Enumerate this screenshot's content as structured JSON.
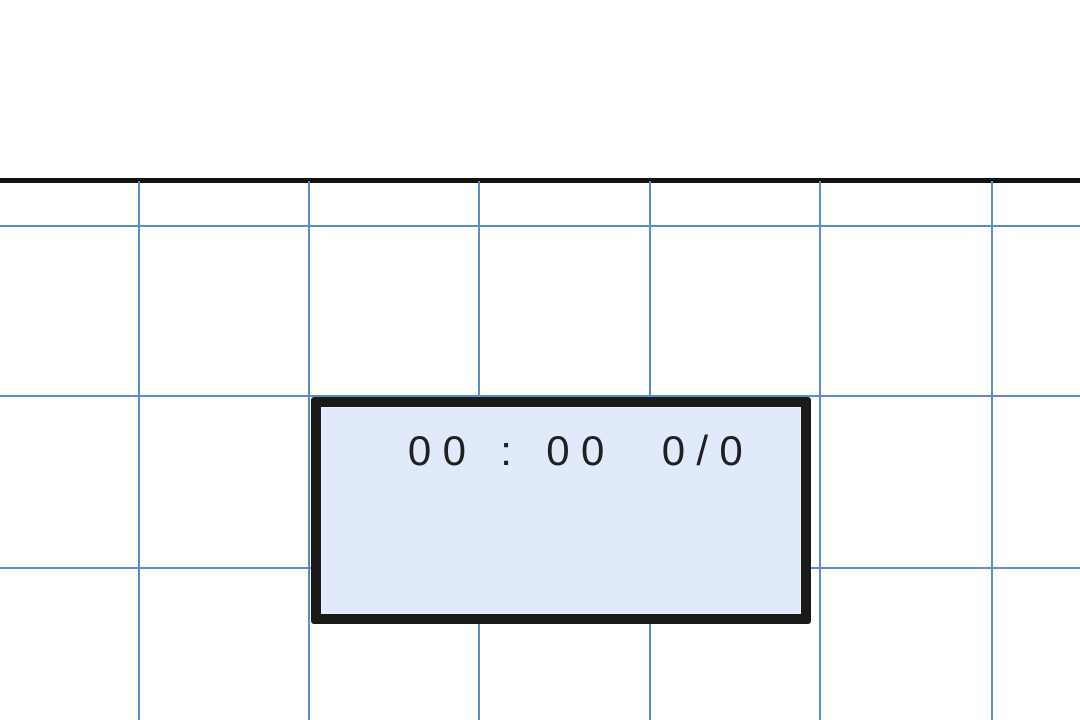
{
  "scene": {
    "background_color": "#ffffff",
    "top_line_color": "#131313"
  },
  "grid": {
    "line_color": "#5b8ec9",
    "line_thickness_px": 2,
    "top": 181,
    "vertical_x": [
      138,
      308,
      478,
      649,
      819,
      991
    ],
    "horizontal_y": [
      225,
      395,
      567
    ]
  },
  "scoreboard": {
    "display_text": "00 : 00  0/0",
    "time": "00:00",
    "score": "0/0",
    "fill_color": "#e0eafb",
    "border_color": "#1a1a1a",
    "text_color": "#202020"
  }
}
